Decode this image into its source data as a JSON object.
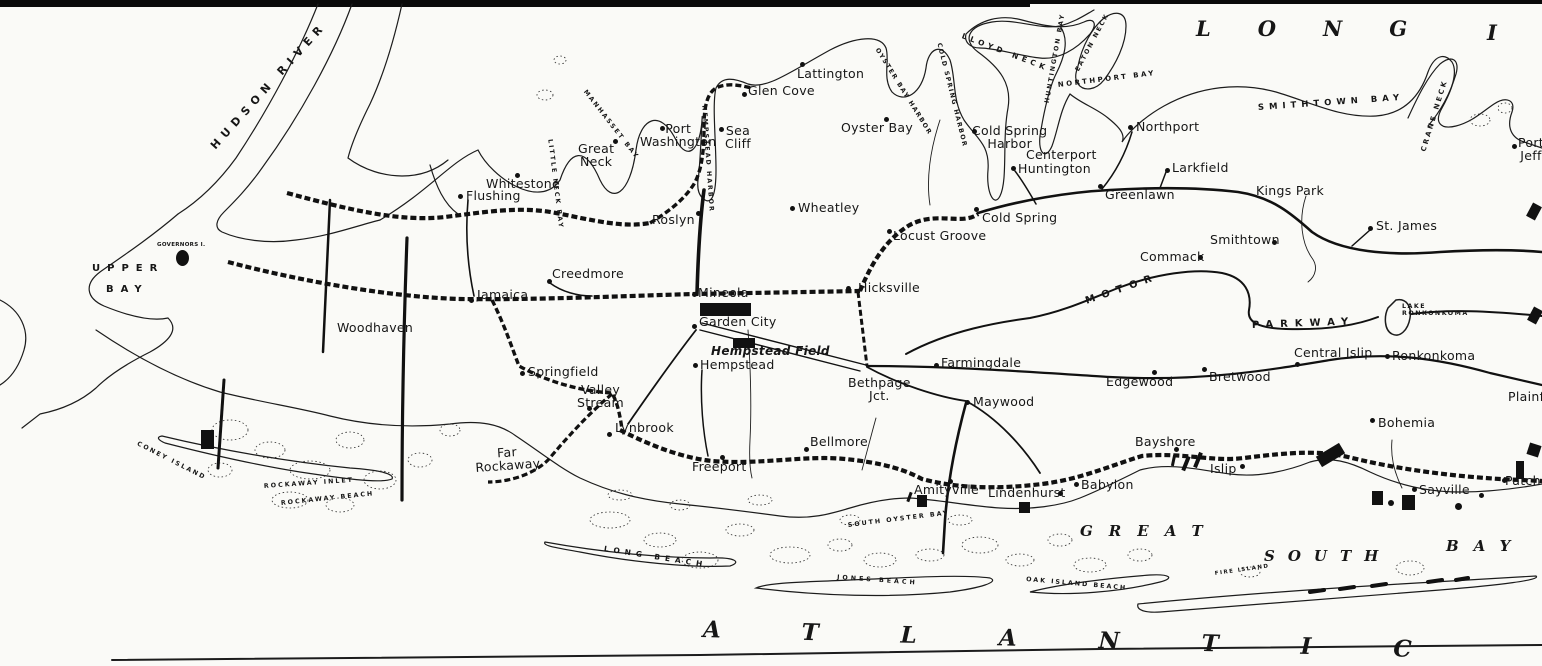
{
  "map_title": "Long Island",
  "colors": {
    "ink": "#161616",
    "paper": "#fafaf7"
  },
  "labels": [
    {
      "id": "flushing",
      "text": "Flushing",
      "x": 466,
      "y": 189,
      "cls": "town"
    },
    {
      "id": "whitestone",
      "text": "Whitestone",
      "x": 486,
      "y": 177,
      "cls": "town"
    },
    {
      "id": "great-neck",
      "text": "Great\nNeck",
      "x": 578,
      "y": 142,
      "cls": "town ctr"
    },
    {
      "id": "port-washington",
      "text": "Port\nWashington",
      "x": 640,
      "y": 122,
      "cls": "town ctr"
    },
    {
      "id": "sea-cliff",
      "text": "Sea\nCliff",
      "x": 725,
      "y": 124,
      "cls": "town ctr"
    },
    {
      "id": "glen-cove",
      "text": "Glen Cove",
      "x": 748,
      "y": 84,
      "cls": "town"
    },
    {
      "id": "roslyn",
      "text": "Roslyn",
      "x": 652,
      "y": 213,
      "cls": "town"
    },
    {
      "id": "lattington",
      "text": "Lattington",
      "x": 797,
      "y": 67,
      "cls": "town"
    },
    {
      "id": "oyster-bay",
      "text": "Oyster Bay",
      "x": 841,
      "y": 121,
      "cls": "town"
    },
    {
      "id": "wheatley",
      "text": "Wheatley",
      "x": 798,
      "y": 201,
      "cls": "town"
    },
    {
      "id": "locust-grove",
      "text": "Locust Groove",
      "x": 893,
      "y": 229,
      "cls": "town"
    },
    {
      "id": "cold-spring-harbor",
      "text": "Cold Spring\nHarbor",
      "x": 972,
      "y": 124,
      "cls": "town ctr"
    },
    {
      "id": "centerport",
      "text": "Centerport",
      "x": 1026,
      "y": 148,
      "cls": "town"
    },
    {
      "id": "huntington",
      "text": "Huntington",
      "x": 1018,
      "y": 162,
      "cls": "town"
    },
    {
      "id": "cold-spring",
      "text": "Cold Spring",
      "x": 982,
      "y": 211,
      "cls": "town"
    },
    {
      "id": "northport",
      "text": "Northport",
      "x": 1136,
      "y": 120,
      "cls": "town"
    },
    {
      "id": "larkfield",
      "text": "Larkfield",
      "x": 1172,
      "y": 161,
      "cls": "town"
    },
    {
      "id": "greenlawn",
      "text": "Greenlawn",
      "x": 1105,
      "y": 188,
      "cls": "town"
    },
    {
      "id": "kings-park",
      "text": "Kings Park",
      "x": 1256,
      "y": 184,
      "cls": "town"
    },
    {
      "id": "smithtown",
      "text": "Smithtown",
      "x": 1210,
      "y": 233,
      "cls": "town"
    },
    {
      "id": "commack",
      "text": "Commack",
      "x": 1140,
      "y": 250,
      "cls": "town"
    },
    {
      "id": "st-james",
      "text": "St. James",
      "x": 1376,
      "y": 219,
      "cls": "town"
    },
    {
      "id": "port-jeff",
      "text": "Port\nJeff",
      "x": 1518,
      "y": 136,
      "cls": "town ctr"
    },
    {
      "id": "creedmore",
      "text": "Creedmore",
      "x": 552,
      "y": 267,
      "cls": "town"
    },
    {
      "id": "jamaica",
      "text": "Jamaica",
      "x": 477,
      "y": 288,
      "cls": "town"
    },
    {
      "id": "woodhaven",
      "text": "Woodhaven",
      "x": 337,
      "y": 321,
      "cls": "town"
    },
    {
      "id": "mineola",
      "text": "Mineola",
      "x": 698,
      "y": 286,
      "cls": "town"
    },
    {
      "id": "garden-city",
      "text": "Garden City",
      "x": 699,
      "y": 315,
      "cls": "town"
    },
    {
      "id": "hempstead-field",
      "text": "Hempstead Field",
      "x": 711,
      "y": 345,
      "cls": "field"
    },
    {
      "id": "hempstead",
      "text": "Hempstead",
      "x": 700,
      "y": 358,
      "cls": "town"
    },
    {
      "id": "hicksville",
      "text": "Hicksville",
      "x": 858,
      "y": 281,
      "cls": "town"
    },
    {
      "id": "springfield",
      "text": "Springfield",
      "x": 528,
      "y": 365,
      "cls": "town"
    },
    {
      "id": "valley-stream",
      "text": "Valley\nStream",
      "x": 577,
      "y": 383,
      "cls": "town ctr"
    },
    {
      "id": "lynbrook",
      "text": "Lynbrook",
      "x": 615,
      "y": 421,
      "cls": "town"
    },
    {
      "id": "far-rockaway",
      "text": "Far\nRockaway",
      "x": 475,
      "y": 448,
      "cls": "town ctr",
      "rot": -4
    },
    {
      "id": "freeport",
      "text": "Freeport",
      "x": 692,
      "y": 460,
      "cls": "town"
    },
    {
      "id": "bellmore",
      "text": "Bellmore",
      "x": 810,
      "y": 435,
      "cls": "town"
    },
    {
      "id": "amityville",
      "text": "Amityville",
      "x": 914,
      "y": 483,
      "cls": "town"
    },
    {
      "id": "lindenhurst",
      "text": "Lindenhurst",
      "x": 988,
      "y": 486,
      "cls": "town"
    },
    {
      "id": "babylon",
      "text": "Babylon",
      "x": 1081,
      "y": 478,
      "cls": "town"
    },
    {
      "id": "bayshore",
      "text": "Bayshore",
      "x": 1135,
      "y": 435,
      "cls": "town"
    },
    {
      "id": "islip",
      "text": "Islip",
      "x": 1210,
      "y": 462,
      "cls": "town"
    },
    {
      "id": "maywood",
      "text": "Maywood",
      "x": 973,
      "y": 395,
      "cls": "town"
    },
    {
      "id": "farmingdale",
      "text": "Farmingdale",
      "x": 941,
      "y": 356,
      "cls": "town"
    },
    {
      "id": "bethpage-jct",
      "text": "Bethpage\nJct.",
      "x": 848,
      "y": 376,
      "cls": "town ctr"
    },
    {
      "id": "edgewood",
      "text": "Edgewood",
      "x": 1106,
      "y": 375,
      "cls": "town"
    },
    {
      "id": "bretwood",
      "text": "Bretwood",
      "x": 1209,
      "y": 370,
      "cls": "town"
    },
    {
      "id": "central-islip",
      "text": "Central Islip",
      "x": 1294,
      "y": 346,
      "cls": "town"
    },
    {
      "id": "ronkonkoma",
      "text": "Ronkonkoma",
      "x": 1392,
      "y": 349,
      "cls": "town"
    },
    {
      "id": "bohemia",
      "text": "Bohemia",
      "x": 1378,
      "y": 416,
      "cls": "town"
    },
    {
      "id": "sayville",
      "text": "Sayville",
      "x": 1419,
      "y": 483,
      "cls": "town"
    },
    {
      "id": "patchogue",
      "text": "Patchogue",
      "x": 1505,
      "y": 474,
      "cls": "town"
    },
    {
      "id": "plainfield",
      "text": "Plainfield",
      "x": 1508,
      "y": 390,
      "cls": "town"
    },
    {
      "id": "governors-island",
      "text": "GOVERNORS I.",
      "x": 157,
      "y": 243,
      "cls": "water-sm",
      "fs": 5.5
    },
    {
      "id": "hudson-river",
      "text": "HUDSON RIVER",
      "x": 213,
      "y": 142,
      "cls": "water",
      "rot": -48,
      "ls": 6,
      "fs": 11
    },
    {
      "id": "upper-bay-1",
      "text": "UPPER",
      "x": 92,
      "y": 264,
      "cls": "water",
      "ls": 7
    },
    {
      "id": "upper-bay-2",
      "text": "BAY",
      "x": 106,
      "y": 285,
      "cls": "water",
      "ls": 7
    },
    {
      "id": "little-neck-bay",
      "text": "LITTLE NECK BAY",
      "x": 549,
      "y": 136,
      "cls": "water-sm",
      "rot": 83,
      "ls": 2
    },
    {
      "id": "manhasset-bay",
      "text": "MANHASSET BAY",
      "x": 584,
      "y": 88,
      "cls": "water-sm",
      "rot": 52,
      "ls": 2
    },
    {
      "id": "hempstead-harbor",
      "text": "HEMPSTEAD HARBOR",
      "x": 703,
      "y": 102,
      "cls": "water-sm",
      "rot": 86,
      "ls": 2
    },
    {
      "id": "oyster-bay-harbor",
      "text": "OYSTER BAY HARBOR",
      "x": 876,
      "y": 46,
      "cls": "water-sm",
      "rot": 58,
      "ls": 1.5
    },
    {
      "id": "cold-spring-harbor-water",
      "text": "COLD SPRING HARBOR",
      "x": 938,
      "y": 40,
      "cls": "water-sm",
      "rot": 76,
      "ls": 1.5
    },
    {
      "id": "lloyd-neck",
      "text": "LLOYD NECK",
      "x": 962,
      "y": 32,
      "cls": "water-md",
      "rot": 21,
      "ls": 4
    },
    {
      "id": "huntington-bay",
      "text": "HUNTINGTON BAY",
      "x": 1048,
      "y": 100,
      "cls": "water-sm",
      "rot": -80,
      "ls": 2
    },
    {
      "id": "eaton-neck",
      "text": "EATON NECK",
      "x": 1078,
      "y": 68,
      "cls": "water-sm",
      "rot": -62,
      "ls": 2
    },
    {
      "id": "northport-bay",
      "text": "NORTHPORT BAY",
      "x": 1058,
      "y": 82,
      "cls": "water-md",
      "rot": -7,
      "ls": 2.5,
      "fs": 7
    },
    {
      "id": "smithtown-bay",
      "text": "SMITHTOWN BAY",
      "x": 1258,
      "y": 104,
      "cls": "water-md",
      "rot": -4,
      "ls": 5,
      "fs": 8.5
    },
    {
      "id": "crane-neck",
      "text": "CRANE NECK",
      "x": 1424,
      "y": 148,
      "cls": "water-md",
      "rot": -73,
      "ls": 2.5,
      "fs": 7
    },
    {
      "id": "motor",
      "text": "MOTOR",
      "x": 1086,
      "y": 297,
      "cls": "water",
      "rot": -19,
      "ls": 7
    },
    {
      "id": "parkway",
      "text": "PARKWAY",
      "x": 1252,
      "y": 321,
      "cls": "water",
      "rot": -2,
      "ls": 7
    },
    {
      "id": "lake-ronkonkoma",
      "text": "LAKE\nRONKONKOMA",
      "x": 1402,
      "y": 304,
      "cls": "water-sm",
      "ls": 1.5
    },
    {
      "id": "long-beach",
      "text": "LONG BEACH",
      "x": 604,
      "y": 545,
      "cls": "water-md",
      "rot": 9,
      "ls": 5
    },
    {
      "id": "rockaway-inlet",
      "text": "ROCKAWAY INLET",
      "x": 264,
      "y": 484,
      "cls": "water-sm",
      "rot": -4,
      "ls": 2
    },
    {
      "id": "rockaway-beach",
      "text": "ROCKAWAY BEACH",
      "x": 281,
      "y": 501,
      "cls": "water-sm",
      "rot": -6,
      "ls": 2
    },
    {
      "id": "coney-island",
      "text": "CONEY ISLAND",
      "x": 137,
      "y": 441,
      "cls": "water-sm",
      "rot": 27,
      "ls": 2
    },
    {
      "id": "south-oyster-bay",
      "text": "SOUTH OYSTER BAY",
      "x": 848,
      "y": 523,
      "cls": "water-sm",
      "rot": -7,
      "ls": 2
    },
    {
      "id": "jones-beach",
      "text": "JONES BEACH",
      "x": 837,
      "y": 575,
      "cls": "water-sm",
      "rot": 4,
      "ls": 3
    },
    {
      "id": "oak-island-beach",
      "text": "OAK ISLAND BEACH",
      "x": 1026,
      "y": 577,
      "cls": "water-sm",
      "rot": 5,
      "ls": 2
    },
    {
      "id": "fire-island",
      "text": "FIRE ISLAND",
      "x": 1215,
      "y": 572,
      "cls": "water-sm",
      "rot": -8,
      "ls": 1.5,
      "fs": 5.5
    },
    {
      "id": "great",
      "text": "GREAT",
      "x": 1080,
      "y": 524,
      "cls": "sea",
      "ls": 16
    },
    {
      "id": "south",
      "text": "SOUTH",
      "x": 1264,
      "y": 549,
      "cls": "sea",
      "ls": 13
    },
    {
      "id": "bay",
      "text": "BAY",
      "x": 1446,
      "y": 539,
      "cls": "sea",
      "ls": 15
    },
    {
      "id": "long-title",
      "text": "LONG",
      "x": 1196,
      "y": 18,
      "cls": "sea-lg",
      "ls": 47
    },
    {
      "id": "island-title-i",
      "text": "I",
      "x": 1487,
      "y": 22,
      "cls": "sea-lg"
    },
    {
      "id": "atlantic",
      "text": "ATLANTIC",
      "x": 703,
      "y": 618,
      "cls": "sea-lg",
      "ls": 82,
      "rot": 1.6,
      "fs": 23
    }
  ],
  "dots": [
    {
      "id": "flushing",
      "x": 460,
      "y": 196
    },
    {
      "id": "whitestone",
      "x": 517,
      "y": 175
    },
    {
      "id": "great-neck",
      "x": 615,
      "y": 141
    },
    {
      "id": "port-washington",
      "x": 662,
      "y": 128
    },
    {
      "id": "sea-cliff",
      "x": 721,
      "y": 129
    },
    {
      "id": "glen-cove",
      "x": 744,
      "y": 94
    },
    {
      "id": "roslyn",
      "x": 698,
      "y": 213
    },
    {
      "id": "lattington",
      "x": 802,
      "y": 64
    },
    {
      "id": "oyster-bay",
      "x": 886,
      "y": 119
    },
    {
      "id": "wheatley",
      "x": 792,
      "y": 208
    },
    {
      "id": "locust-grove",
      "x": 889,
      "y": 231
    },
    {
      "id": "cold-spring-harbor",
      "x": 974,
      "y": 131
    },
    {
      "id": "huntington",
      "x": 1013,
      "y": 168
    },
    {
      "id": "cold-spring",
      "x": 976,
      "y": 209
    },
    {
      "id": "northport",
      "x": 1130,
      "y": 127
    },
    {
      "id": "larkfield",
      "x": 1167,
      "y": 170
    },
    {
      "id": "greenlawn",
      "x": 1100,
      "y": 186
    },
    {
      "id": "smithtown",
      "x": 1274,
      "y": 242
    },
    {
      "id": "commack",
      "x": 1200,
      "y": 257
    },
    {
      "id": "st-james",
      "x": 1370,
      "y": 228
    },
    {
      "id": "port-jeff",
      "x": 1514,
      "y": 146
    },
    {
      "id": "creedmore",
      "x": 549,
      "y": 281
    },
    {
      "id": "jamaica",
      "x": 471,
      "y": 300
    },
    {
      "id": "mineola",
      "x": 694,
      "y": 294
    },
    {
      "id": "garden-city",
      "x": 694,
      "y": 326
    },
    {
      "id": "hempstead",
      "x": 695,
      "y": 365
    },
    {
      "id": "hicksville",
      "x": 848,
      "y": 288
    },
    {
      "id": "springfield",
      "x": 522,
      "y": 373
    },
    {
      "id": "valley-stream",
      "x": 589,
      "y": 408
    },
    {
      "id": "lynbrook",
      "x": 609,
      "y": 434
    },
    {
      "id": "freeport",
      "x": 722,
      "y": 457
    },
    {
      "id": "bellmore",
      "x": 806,
      "y": 449
    },
    {
      "id": "amityville",
      "x": 950,
      "y": 481
    },
    {
      "id": "lindenhurst",
      "x": 1060,
      "y": 493
    },
    {
      "id": "babylon",
      "x": 1076,
      "y": 484
    },
    {
      "id": "bayshore",
      "x": 1176,
      "y": 449
    },
    {
      "id": "islip",
      "x": 1242,
      "y": 466
    },
    {
      "id": "maywood",
      "x": 967,
      "y": 402
    },
    {
      "id": "farmingdale",
      "x": 936,
      "y": 365
    },
    {
      "id": "edgewood",
      "x": 1154,
      "y": 372
    },
    {
      "id": "bretwood",
      "x": 1204,
      "y": 369
    },
    {
      "id": "central-islip",
      "x": 1297,
      "y": 364
    },
    {
      "id": "ronkonkoma",
      "x": 1387,
      "y": 356
    },
    {
      "id": "bohemia",
      "x": 1372,
      "y": 420
    },
    {
      "id": "sayville",
      "x": 1414,
      "y": 489
    },
    {
      "id": "sayville-east",
      "x": 1481,
      "y": 495
    },
    {
      "id": "patchogue",
      "x": 1504,
      "y": 480
    }
  ],
  "markers": [
    {
      "id": "governors-island-blob",
      "x": 176,
      "y": 250,
      "w": 13,
      "h": 16,
      "rot": 0,
      "shape": "round"
    },
    {
      "id": "coney-island-field",
      "x": 201,
      "y": 430,
      "w": 13,
      "h": 19,
      "rot": 0
    },
    {
      "id": "garden-city-field",
      "x": 700,
      "y": 303,
      "w": 51,
      "h": 13,
      "rot": 0
    },
    {
      "id": "hempstead-field-block",
      "x": 733,
      "y": 338,
      "w": 22,
      "h": 10,
      "rot": 0
    },
    {
      "id": "amityville-block",
      "x": 917,
      "y": 495,
      "w": 10,
      "h": 12,
      "rot": 0
    },
    {
      "id": "amityville-tick",
      "x": 908,
      "y": 492,
      "w": 3,
      "h": 10,
      "rot": 20
    },
    {
      "id": "lindenhurst-block",
      "x": 1019,
      "y": 502,
      "w": 11,
      "h": 11,
      "rot": 0
    },
    {
      "id": "islip-tick-1",
      "x": 1184,
      "y": 456,
      "w": 4,
      "h": 15,
      "rot": 22
    },
    {
      "id": "islip-tick-2",
      "x": 1196,
      "y": 452,
      "w": 4,
      "h": 16,
      "rot": 22
    },
    {
      "id": "islip-tick-3",
      "x": 1172,
      "y": 455,
      "w": 3,
      "h": 11,
      "rot": 12
    },
    {
      "id": "shore-block-west",
      "x": 1317,
      "y": 449,
      "w": 27,
      "h": 12,
      "rot": -31
    },
    {
      "id": "sayville-block-1",
      "x": 1372,
      "y": 491,
      "w": 11,
      "h": 14,
      "rot": 0
    },
    {
      "id": "sayville-block-2",
      "x": 1402,
      "y": 495,
      "w": 13,
      "h": 15,
      "rot": 0
    },
    {
      "id": "sayville-circle-1",
      "x": 1388,
      "y": 500,
      "w": 6,
      "h": 6,
      "rot": 0,
      "shape": "round"
    },
    {
      "id": "sayville-circle-2",
      "x": 1455,
      "y": 503,
      "w": 7,
      "h": 7,
      "rot": 0,
      "shape": "round"
    },
    {
      "id": "patchogue-mark",
      "x": 1516,
      "y": 461,
      "w": 8,
      "h": 18,
      "rot": 0
    },
    {
      "id": "edge-wedge-1",
      "x": 1529,
      "y": 204,
      "w": 10,
      "h": 15,
      "rot": 28
    },
    {
      "id": "edge-wedge-2",
      "x": 1530,
      "y": 308,
      "w": 10,
      "h": 15,
      "rot": 28
    },
    {
      "id": "edge-wedge-3",
      "x": 1528,
      "y": 444,
      "w": 12,
      "h": 12,
      "rot": 18
    }
  ]
}
